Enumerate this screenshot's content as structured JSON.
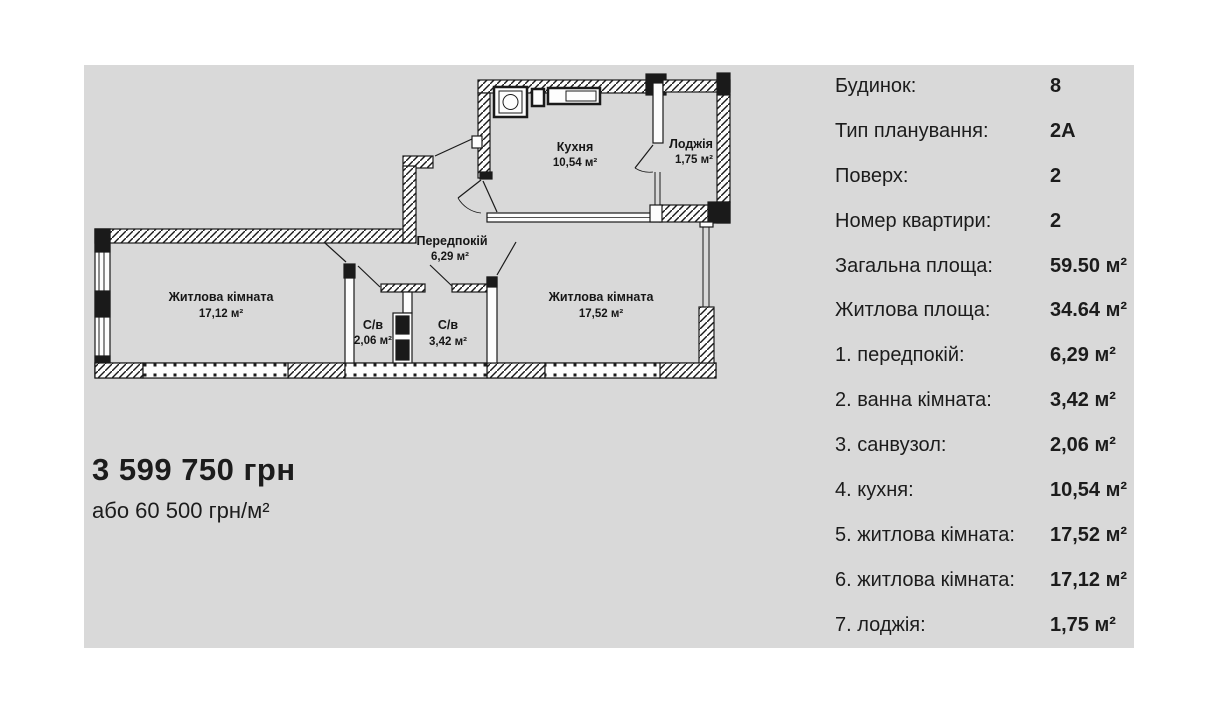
{
  "colors": {
    "panel_bg": "#d9d9d9",
    "wall": "#1a1a1a",
    "text": "#1c1c1c"
  },
  "panel": {
    "price": "3 599 750 грн",
    "price_alt": "або 60 500 грн/м²",
    "details": [
      {
        "label": "Будинок:",
        "value": "8"
      },
      {
        "label": "Тип планування:",
        "value": "2А"
      },
      {
        "label": "Поверх:",
        "value": "2"
      },
      {
        "label": "Номер квартири:",
        "value": "2"
      },
      {
        "label": "Загальна площа:",
        "value": "59.50 м²"
      },
      {
        "label": "Житлова площа:",
        "value": "34.64 м²"
      },
      {
        "label": "1. передпокій:",
        "value": "6,29 м²"
      },
      {
        "label": "2. ванна кімната:",
        "value": "3,42 м²"
      },
      {
        "label": "3. санвузол:",
        "value": "2,06 м²"
      },
      {
        "label": "4. кухня:",
        "value": "10,54 м²"
      },
      {
        "label": "5. житлова кімната:",
        "value": "17,52 м²"
      },
      {
        "label": "6. житлова кімната:",
        "value": "17,12 м²"
      },
      {
        "label": "7. лоджія:",
        "value": "1,75 м²"
      }
    ]
  },
  "plan": {
    "rooms": [
      {
        "name": "Кухня",
        "area": "10,54 м²"
      },
      {
        "name": "Лоджія",
        "area": "1,75 м²"
      },
      {
        "name": "Передпокій",
        "area": "6,29 м²"
      },
      {
        "name": "Житлова кімната",
        "area": "17,12 м²"
      },
      {
        "name": "С/в",
        "area": "2,06 м²"
      },
      {
        "name": "С/в",
        "area": "3,42 м²"
      },
      {
        "name": "Житлова кімната",
        "area": "17,52 м²"
      }
    ]
  }
}
